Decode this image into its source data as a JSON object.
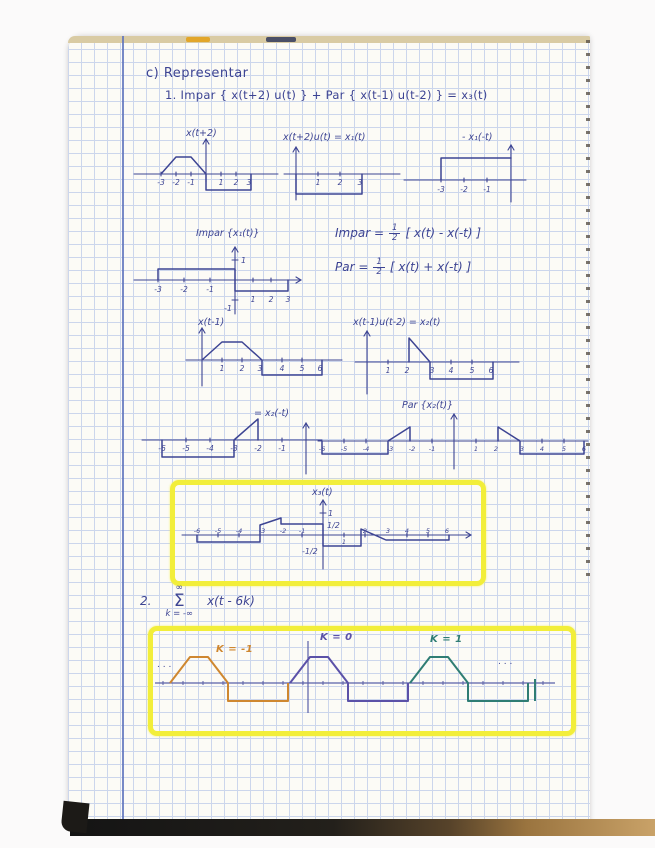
{
  "header": {
    "title": "c) Representar",
    "problem": "1.  Impar { x(t+2) u(t) }  +  Par { x(t-1) u(t-2) }  =  x₃(t)"
  },
  "graph_xtp2": {
    "label": "x(t+2)",
    "ticks": [
      "-3",
      "-2",
      "-1",
      "1",
      "2",
      "3"
    ]
  },
  "graph_x1": {
    "label": "x(t+2)u(t) = x₁(t)",
    "ticks": [
      "1",
      "2",
      "3"
    ]
  },
  "graph_negx1": {
    "label": "- x₁(-t)",
    "ticks": [
      "-3",
      "-2",
      "-1"
    ]
  },
  "graph_impar": {
    "label": "Impar {x₁(t)}",
    "y_pos": "1",
    "y_neg": "-1",
    "ticks": [
      "-3",
      "-2",
      "-1",
      "1",
      "2",
      "3"
    ]
  },
  "formulas": {
    "frac_num": "1",
    "frac_den": "2",
    "impar_lhs": "Impar =",
    "impar_rhs": "[ x(t) - x(-t) ]",
    "par_lhs": "Par =",
    "par_rhs": "[ x(t) + x(-t) ]"
  },
  "graph_xtm1": {
    "label": "x(t-1)",
    "ticks": [
      "1",
      "2",
      "3",
      "4",
      "5",
      "6"
    ]
  },
  "graph_x2": {
    "label": "x(t-1)u(t-2) = x₂(t)",
    "ticks": [
      "1",
      "2",
      "3",
      "4",
      "5",
      "6"
    ]
  },
  "graph_x2neg": {
    "label": "= x₂(-t)",
    "ticks": [
      "-6",
      "-5",
      "-4",
      "-3",
      "-2",
      "-1"
    ]
  },
  "graph_parx2": {
    "label": "Par {x₂(t)}",
    "ticks": [
      "-6",
      "-5",
      "-4",
      "-3",
      "-2",
      "-1",
      "1",
      "2",
      "3",
      "4",
      "5",
      "6"
    ]
  },
  "graph_x3": {
    "label": "x₃(t)",
    "y_one": "1",
    "y_half": "1/2",
    "y_neghalf": "-1/2",
    "ticks": [
      "-6",
      "-5",
      "-4",
      "-3",
      "-2",
      "-1",
      "1",
      "2",
      "3",
      "4",
      "5",
      "6"
    ]
  },
  "problem2": {
    "index": "2.",
    "sum_upper": "∞",
    "sum_sigma": "Σ",
    "sum_lower": "k = -∞",
    "expr": "x(t - 6k)"
  },
  "periodic": {
    "label_km1": "K = -1",
    "label_k0": "K = 0",
    "label_k1": "K = 1",
    "dots_left": ". . .",
    "dots_right": ". . .",
    "color_km1": "#cf8730",
    "color_k0": "#5b51a8",
    "color_k1": "#2f7d74",
    "highlight": "#f2ee3a"
  }
}
